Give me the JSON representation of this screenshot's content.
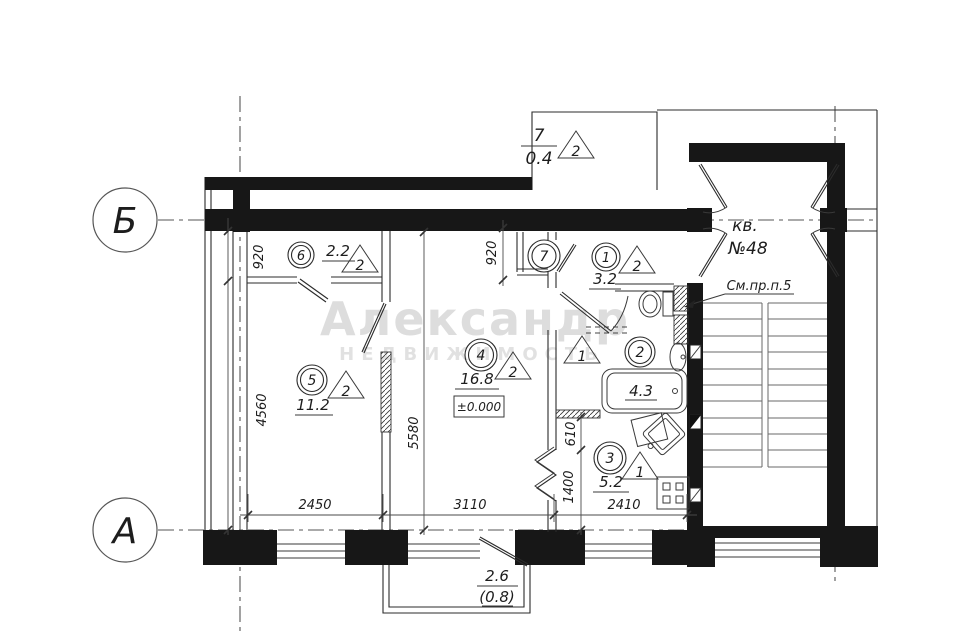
{
  "axes": {
    "b": "Б",
    "a": "А"
  },
  "balcony_top": {
    "num": "7",
    "area": "0.4",
    "marker": "2"
  },
  "balcony_bottom": {
    "area": "2.6",
    "area_alt": "(0.8)"
  },
  "rooms": {
    "r1": {
      "num": "1",
      "area": "3.2",
      "tri": "2"
    },
    "r2": {
      "num": "2",
      "area": "4.3",
      "tri": "1"
    },
    "r3": {
      "num": "3",
      "area": "5.2",
      "tri": "1"
    },
    "r4": {
      "num": "4",
      "area": "16.8",
      "tri": "2",
      "level": "±0.000"
    },
    "r5": {
      "num": "5",
      "area": "11.2",
      "tri": "2"
    },
    "r6": {
      "num": "6",
      "area": "2.2",
      "tri": "2"
    },
    "r7": {
      "num": "7"
    }
  },
  "apartment": {
    "line1": "кв.",
    "line2": "№48",
    "note": "См.пр.п.5"
  },
  "dims": {
    "d2450": "2450",
    "d3110": "3110",
    "d2410": "2410",
    "d920l": "920",
    "d920r": "920",
    "d4560": "4560",
    "d5580": "5580",
    "d610": "610",
    "d1400": "1400"
  },
  "watermark": {
    "line1": "Александр",
    "line2": "НЕДВИЖИМОСТЬ"
  }
}
